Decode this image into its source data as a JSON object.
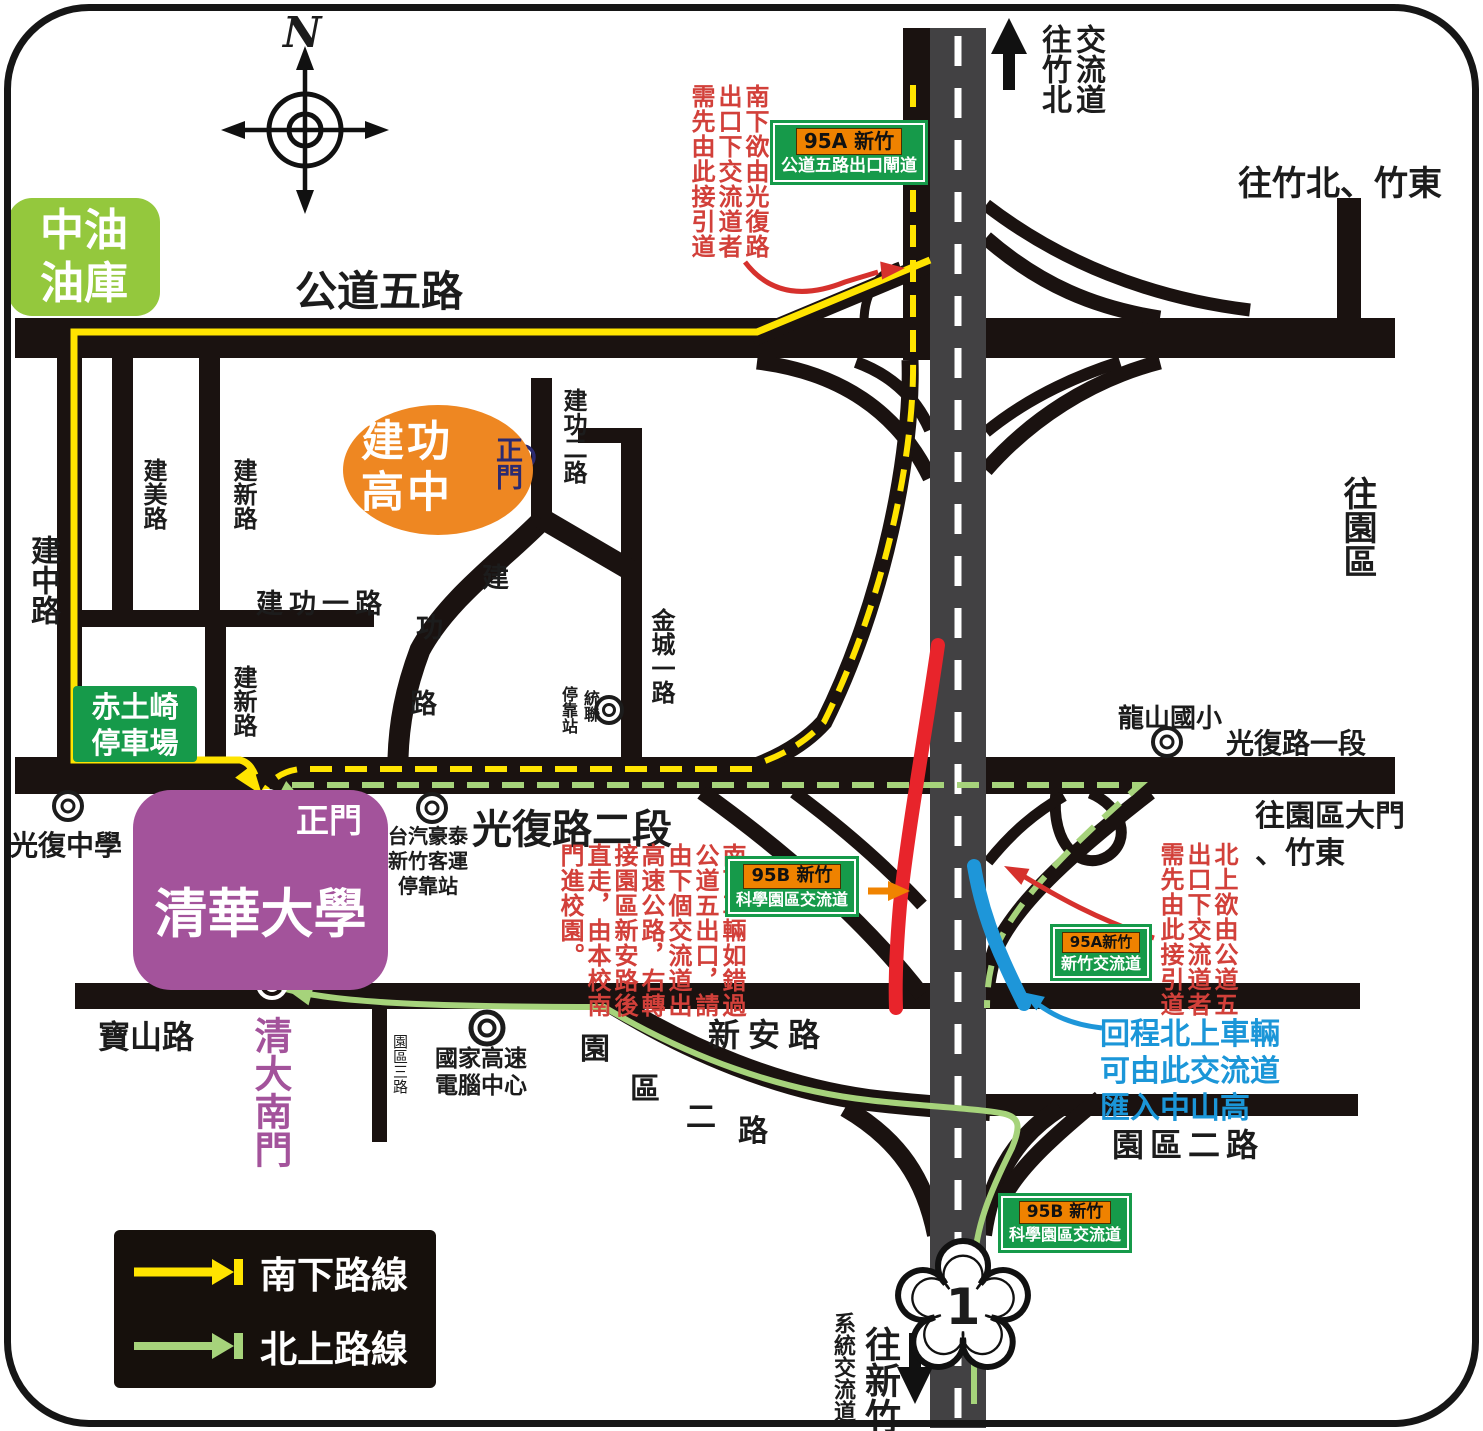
{
  "compass": {
    "north": "N"
  },
  "roads": {
    "gongdao5": "公道五路",
    "jianzhong": "建中路",
    "jianmei": "建美路",
    "jianxin_upper": "建新路",
    "jianxin_lower": "建新路",
    "jiangong1": "建功一路",
    "jiangong2": "建功二路",
    "jiangong_chars": [
      "建",
      "功",
      "路"
    ],
    "jincheng1": "金城一路",
    "guangfu_sec1": "光復路一段",
    "guangfu_sec2": "光復路二段",
    "baoshan": "寶山路",
    "xinan": "新安路",
    "park2_chars": [
      "園",
      "區",
      "二",
      "路"
    ],
    "park2": "園區二路",
    "park3": "園區三路"
  },
  "landmarks": {
    "cpc_depot": {
      "line1": "中油",
      "line2": "油庫"
    },
    "jiangong_hs": {
      "line1": "建功",
      "line2": "高中",
      "gate": "正門"
    },
    "chitu_parking": {
      "line1": "赤土崎",
      "line2": "停車場"
    },
    "nthu": {
      "name": "清華大學",
      "main_gate": "正門",
      "south_gate": "清大南門"
    },
    "guangfu_hs": "光復中學",
    "longshan_es": "龍山國小",
    "ubus_stop": {
      "col_right": "統聯",
      "col_left": "停靠站"
    },
    "taiqi_stop": {
      "line1": "台汽豪泰",
      "line2": "新竹客運",
      "line3": "停靠站"
    },
    "nchc": {
      "line1": "國家高速",
      "line2": "電腦中心"
    }
  },
  "directions": {
    "to_zhubei_interchange": "交流道往竹北",
    "to_zhubei_zhudong": "往竹北、竹東",
    "to_park": "往園區",
    "to_park_gate": {
      "line1": "往園區大門",
      "line2": "、竹東"
    },
    "to_hsinchu": "往新竹",
    "system_interchange": "系統交流道"
  },
  "signs": {
    "gongdao_exit": {
      "code": "95A 新竹",
      "name": "公道五路出口閘道"
    },
    "science_park_mid": {
      "code": "95B 新竹",
      "name": "科學園區交流道"
    },
    "hsinchu_ic": {
      "code": "95A新竹",
      "name": "新竹交流道"
    },
    "science_park_bottom": {
      "code": "95B 新竹",
      "name": "科學園區交流道"
    }
  },
  "annotations": {
    "southbound_guangfu_exit": "南下欲由光復路出口下交流道者需先由此接引道",
    "southbound_missed_exit": "南下車輛如錯過公道五出口，請由下個交流道出高速公路，右轉接園區新安路後直走，由本校南門進校園。",
    "northbound_gongdao_exit": "北上欲由公道五出口下交流道者需先由此接引道",
    "return_north": {
      "line1": "回程北上車輛",
      "line2": "可由此交流道",
      "line3": "匯入中山高"
    }
  },
  "legend": {
    "southbound": "南下路線",
    "northbound": "北上路線"
  },
  "highway": {
    "number": "1"
  },
  "colors": {
    "southbound_yellow": "#ffe400",
    "northbound_green": "#a6d37b",
    "highlight_red": "#e8242b",
    "highlight_blue": "#1e96d9",
    "sign_green": "#169a4a",
    "nthu_purple": "#a3539b",
    "school_orange": "#ee8722",
    "cpc_green": "#94c83d",
    "road_black": "#1a1210",
    "highway_gray": "#424143"
  }
}
